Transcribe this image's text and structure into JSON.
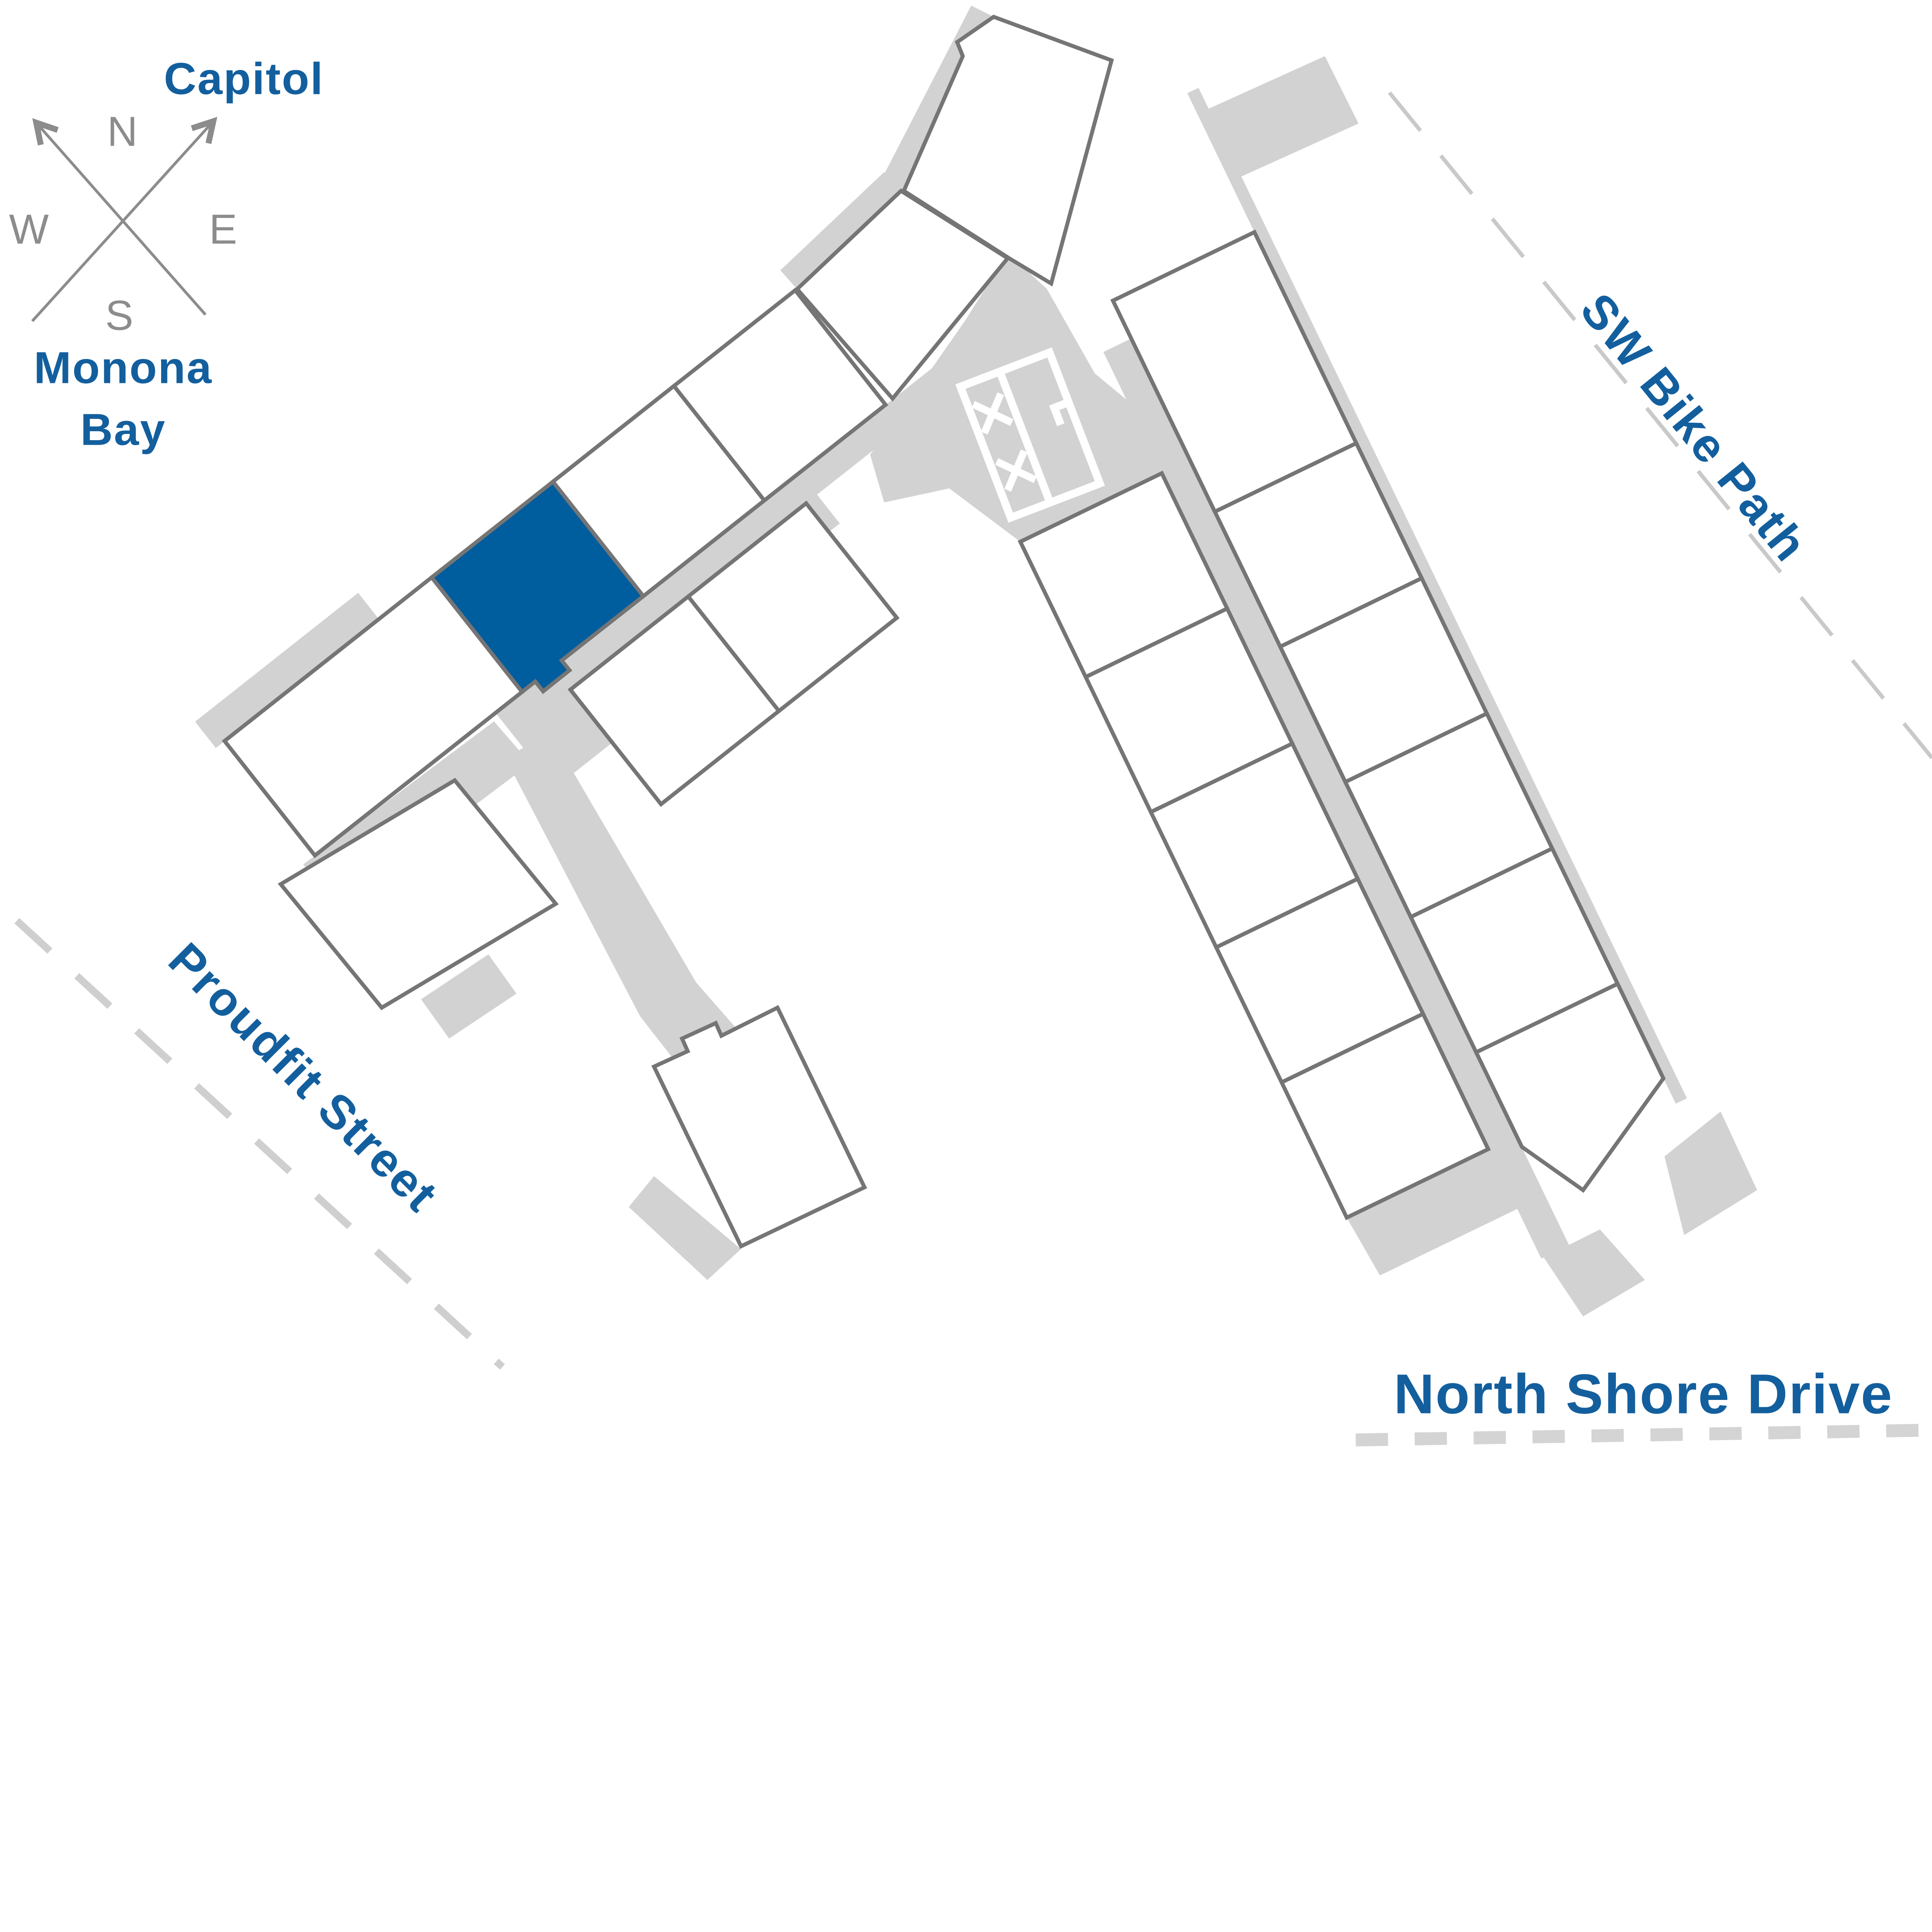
{
  "map": {
    "type": "building-site-locator-floorplan",
    "compass": {
      "north": "N",
      "east": "E",
      "south": "S",
      "west": "W"
    },
    "landmarks": {
      "capitol": "Capitol",
      "monona_bay_line1": "Monona",
      "monona_bay_line2": "Bay"
    },
    "streets": {
      "sw_bike_path": "SW Bike Path",
      "proudfit_street": "Proudfit Street",
      "north_shore_drive": "North Shore Drive"
    },
    "selected_unit": {
      "highlighted": true
    }
  },
  "colors": {
    "selected_unit": "#005D9E",
    "label_text": "#135F9E",
    "floorplan_outline": "#757575",
    "unit_fill": "#FFFFFF",
    "common_area": "#D2D2D2",
    "street_dash_light": "#CFCFCF",
    "street_dash_thick": "#D4D4D4",
    "bike_path_dash": "#C9C9C9",
    "compass_gray": "#8C8C8C"
  }
}
